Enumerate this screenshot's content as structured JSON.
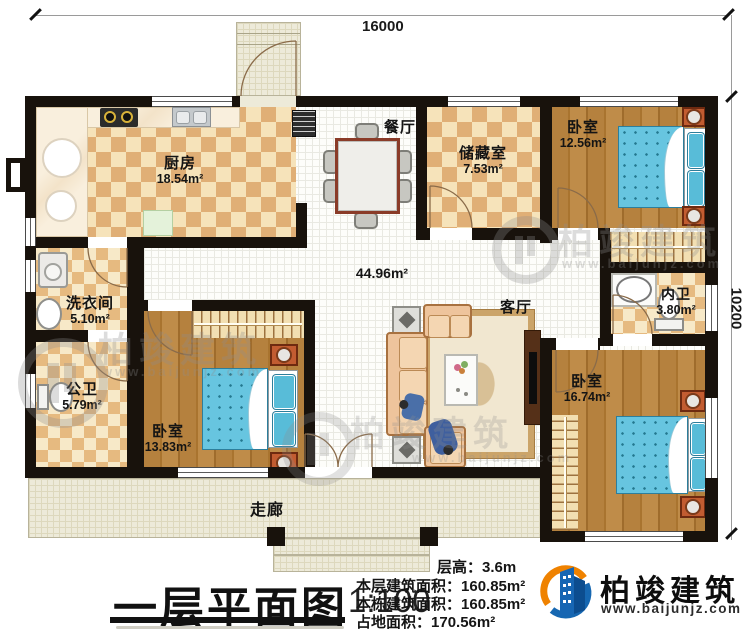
{
  "dimensions": {
    "top": "16000",
    "right": "10200"
  },
  "rooms": {
    "kitchen": {
      "name": "厨房",
      "area": "18.54m²"
    },
    "dining": {
      "name": "餐厅"
    },
    "great_room": {
      "area": "44.96m²"
    },
    "living": {
      "name": "客厅"
    },
    "storage": {
      "name": "储藏室",
      "area": "7.53m²"
    },
    "bedroom_ne": {
      "name": "卧室",
      "area": "12.56m²"
    },
    "laundry": {
      "name": "洗衣间",
      "area": "5.10m²"
    },
    "public_bath": {
      "name": "公卫",
      "area": "5.79m²"
    },
    "bedroom_sw": {
      "name": "卧室",
      "area": "13.83m²"
    },
    "ensuite_bath": {
      "name": "内卫",
      "area": "3.80m²"
    },
    "bedroom_se": {
      "name": "卧室",
      "area": "16.74m²"
    },
    "corridor": {
      "name": "走廊"
    }
  },
  "title": {
    "text": "一层平面图",
    "scale": "1:100"
  },
  "info": {
    "lines": [
      {
        "label": "层高：",
        "value": "3.6m"
      },
      {
        "label": "本层建筑面积：",
        "value": "160.85m²"
      },
      {
        "label": "本栋建筑面积：",
        "value": "160.85m²"
      },
      {
        "label": "占地面积：",
        "value": "170.56m²"
      }
    ]
  },
  "brand": {
    "name": "柏竣建筑",
    "website": "www.baijunjz.com"
  },
  "watermark": {
    "name": "柏竣建筑",
    "website": "www.baijunjz.com"
  },
  "colors": {
    "wall": "#18120c",
    "accent_blue": "#1667b1",
    "accent_orange": "#ef8200",
    "bed_blue": "#67c5e0",
    "wood": "#b5813e"
  }
}
